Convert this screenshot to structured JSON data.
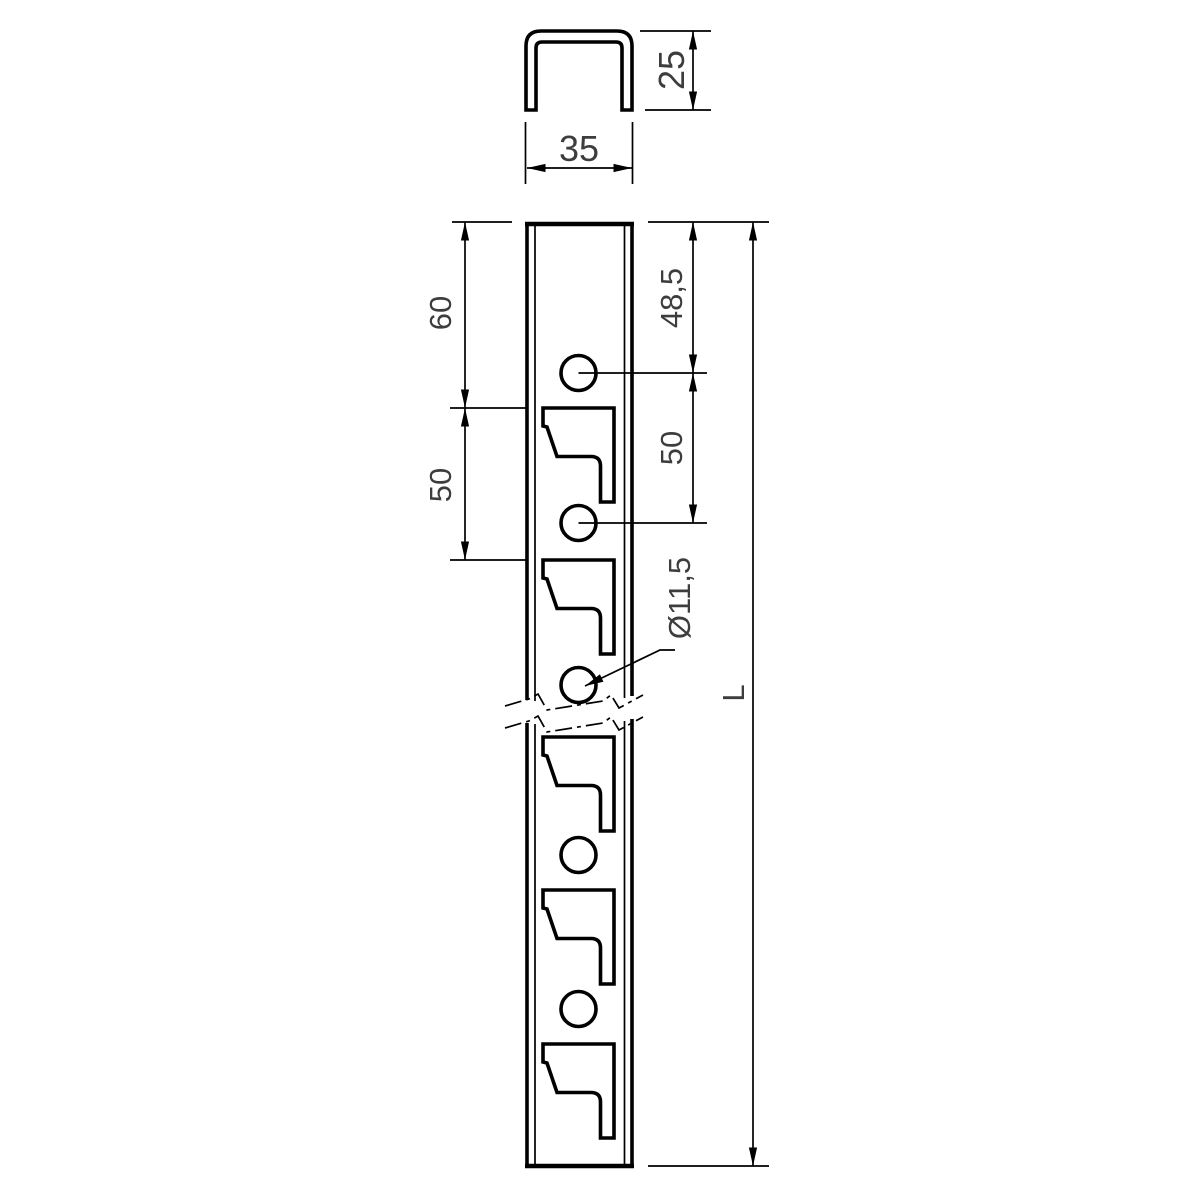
{
  "colors": {
    "background": "#ffffff",
    "line": "#000000",
    "text": "#3d3d3d"
  },
  "cross_section_view": {
    "width_label": "35",
    "depth_label": "25"
  },
  "profile_view": {
    "left_dimensions": [
      "60",
      "50"
    ],
    "right_dimensions": [
      "48,5",
      "50"
    ],
    "hole_callout": "Ø11,5",
    "length_label": "L"
  }
}
